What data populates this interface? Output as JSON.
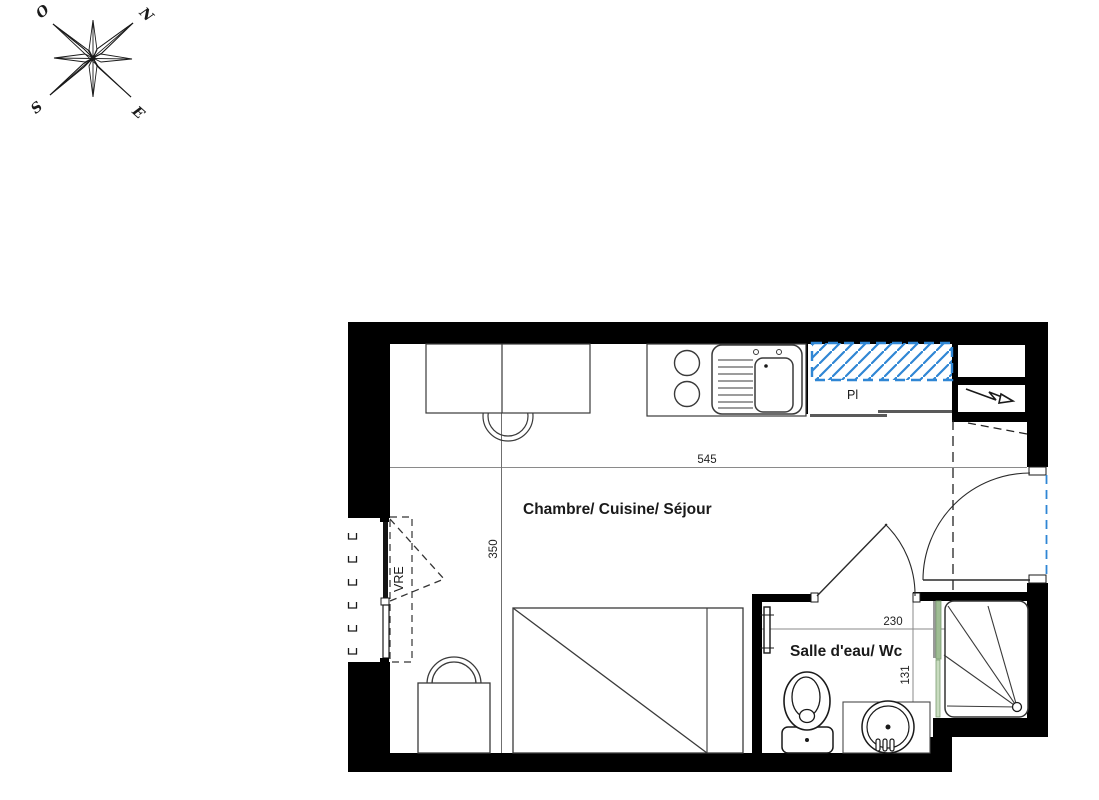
{
  "compass": {
    "west": "O",
    "north": "N",
    "south": "S",
    "east": "E"
  },
  "plan": {
    "main_room": {
      "label": "Chambre/ Cuisine/ Séjour",
      "width_cm": "545",
      "depth_cm": "350"
    },
    "bathroom": {
      "label": "Salle d'eau/ Wc",
      "width_cm": "230",
      "depth_cm": "131"
    },
    "closet_label": "Pl",
    "shutter_label": "VRE"
  },
  "colors": {
    "wall": "#000000",
    "line": "#3a3a3a",
    "dim_gray": "#8a8a8a",
    "hatch_blue": "#2f86d4",
    "glass_green": "#9fbd94",
    "rail_gray": "#5a5a5a"
  }
}
